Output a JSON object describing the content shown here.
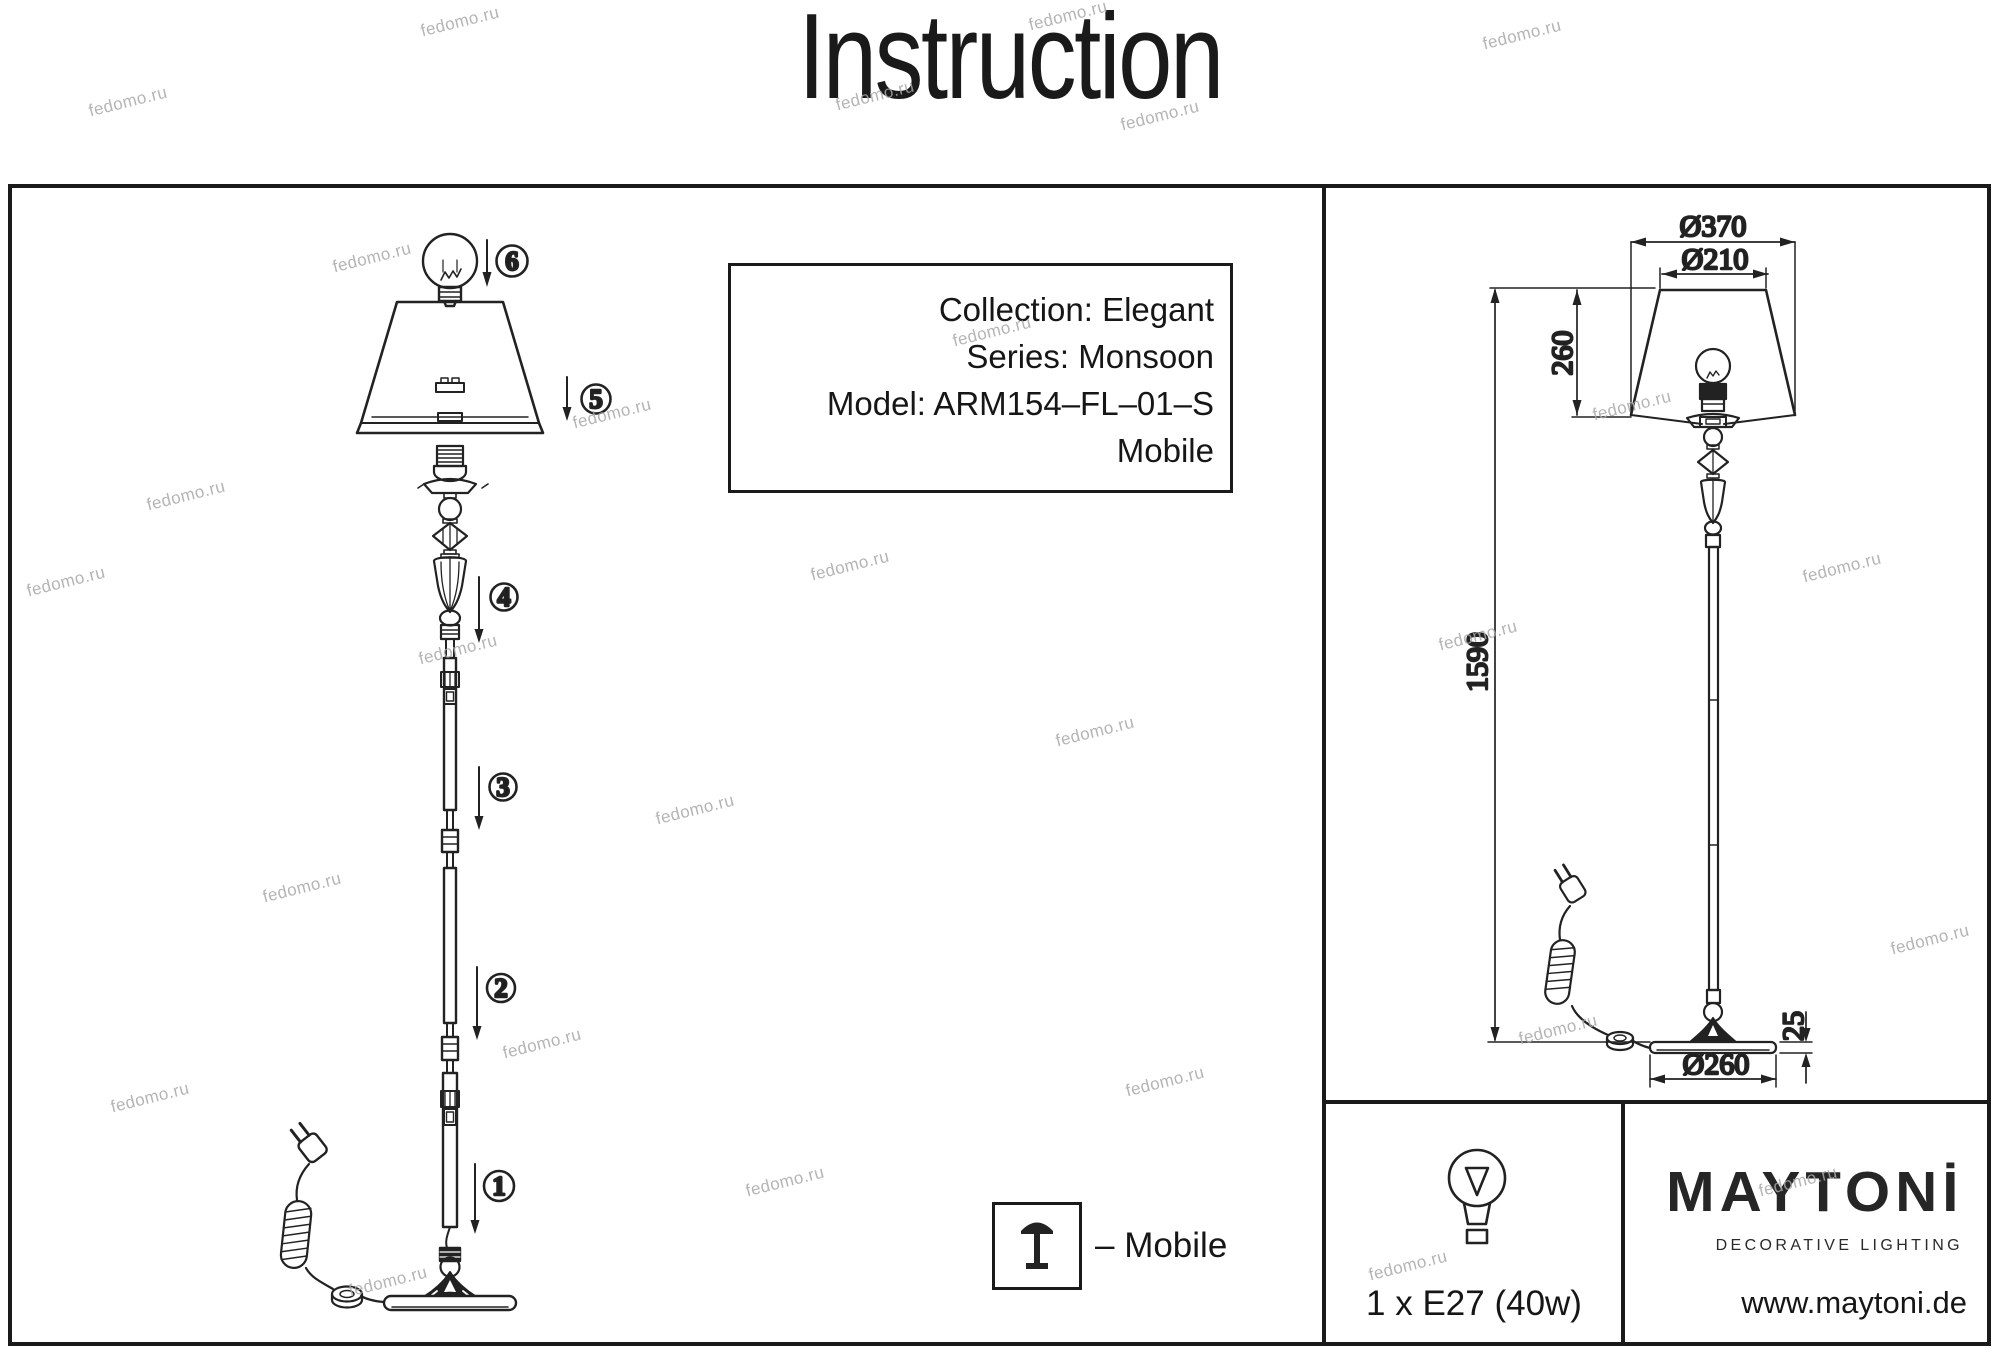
{
  "page": {
    "title": "Instruction"
  },
  "watermark": {
    "text": "fedomo.ru"
  },
  "info_box": {
    "collection": "Collection: Elegant",
    "series": "Series: Monsoon",
    "model": "Model: ARM154–FL–01–S",
    "variant": "Mobile"
  },
  "exploded_view": {
    "steps": [
      "1",
      "2",
      "3",
      "4",
      "5",
      "6"
    ]
  },
  "dimension_view": {
    "shade_bottom_diameter": "Ø370",
    "shade_top_diameter": "Ø210",
    "shade_height": "260",
    "lamp_height": "1590",
    "base_thickness": "25",
    "base_diameter": "Ø260"
  },
  "legend": {
    "mobile": "– Mobile"
  },
  "spec": {
    "bulb": "1 x E27 (40w)"
  },
  "brand": {
    "logo": "MAYTONİ",
    "tagline": "DECORATIVE LIGHTING",
    "website": "www.maytoni.de"
  }
}
